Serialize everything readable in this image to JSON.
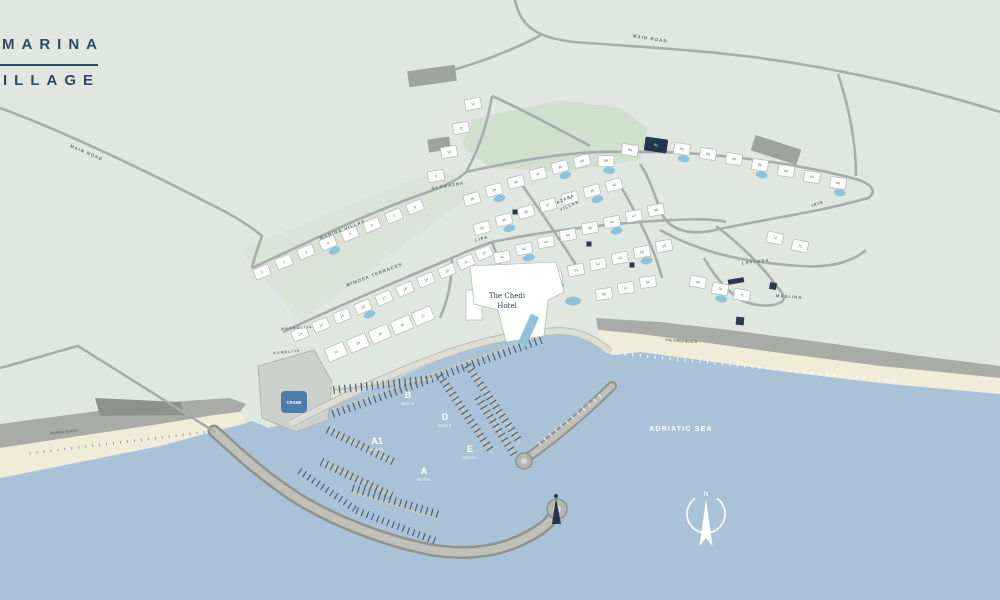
{
  "logo": {
    "line1": "MARINA",
    "line2": "VILLAGE"
  },
  "labels": {
    "main_road_top": "MAIN ROAD",
    "main_road_left": "MAIN ROAD",
    "marina_villas": "MARINA VILLAS",
    "mimosa_terraces": "MIMOSA TERRACES",
    "magnolija": "MAGNOLIJA",
    "kamelija": "KAMELIJA",
    "glomazna": "GLOMAZNA",
    "azara_villas_1": "AZARA",
    "azara_villas_2": "VILLAS",
    "lipa": "LIPA",
    "lavanda": "LAVANDA",
    "maslina": "MASLINA",
    "iris": "IRIS",
    "hotel_line1": "The Chedi",
    "hotel_line2": "Hotel",
    "chedi_beach": "THE CHEDI BEACH",
    "marina_beach": "MARINA BEACH",
    "adriatic_sea": "ADRIATIC SEA",
    "crane": "CRANE",
    "north": "N",
    "berth_word": "BERTH"
  },
  "berths": [
    {
      "name": "B",
      "x": 408,
      "y": 398
    },
    {
      "name": "D",
      "x": 445,
      "y": 420
    },
    {
      "name": "A1",
      "x": 377,
      "y": 444
    },
    {
      "name": "E",
      "x": 470,
      "y": 452
    },
    {
      "name": "A",
      "x": 424,
      "y": 474
    }
  ],
  "villas": [
    {
      "n": "1",
      "x": 262,
      "y": 272,
      "r": -23
    },
    {
      "n": "2",
      "x": 284,
      "y": 262,
      "r": -23
    },
    {
      "n": "3",
      "x": 306,
      "y": 252,
      "r": -23
    },
    {
      "n": "4",
      "x": 328,
      "y": 243,
      "r": -23,
      "p": true
    },
    {
      "n": "5",
      "x": 350,
      "y": 234,
      "r": -23
    },
    {
      "n": "6",
      "x": 372,
      "y": 225,
      "r": -23
    },
    {
      "n": "7",
      "x": 394,
      "y": 216,
      "r": -23
    },
    {
      "n": "8",
      "x": 415,
      "y": 207,
      "r": -23
    },
    {
      "n": "9",
      "x": 436,
      "y": 176,
      "r": -10
    },
    {
      "n": "10",
      "x": 449,
      "y": 152,
      "r": -10
    },
    {
      "n": "11",
      "x": 461,
      "y": 128,
      "r": -10
    },
    {
      "n": "12",
      "x": 473,
      "y": 104,
      "r": -10
    },
    {
      "n": "13",
      "x": 300,
      "y": 334,
      "r": -23
    },
    {
      "n": "14",
      "x": 321,
      "y": 325,
      "r": -23
    },
    {
      "n": "15",
      "x": 342,
      "y": 316,
      "r": -23
    },
    {
      "n": "16",
      "x": 363,
      "y": 307,
      "r": -23,
      "p": true
    },
    {
      "n": "17",
      "x": 384,
      "y": 298,
      "r": -23
    },
    {
      "n": "18",
      "x": 405,
      "y": 289,
      "r": -23
    },
    {
      "n": "19",
      "x": 426,
      "y": 280,
      "r": -23
    },
    {
      "n": "20",
      "x": 447,
      "y": 271,
      "r": -23
    },
    {
      "n": "21",
      "x": 466,
      "y": 262,
      "r": -23
    },
    {
      "n": "22",
      "x": 484,
      "y": 253,
      "r": -23
    },
    {
      "n": "23",
      "x": 336,
      "y": 352,
      "r": -23,
      "w": 20,
      "h": 14
    },
    {
      "n": "24",
      "x": 358,
      "y": 343,
      "r": -23,
      "w": 20,
      "h": 14
    },
    {
      "n": "25",
      "x": 380,
      "y": 334,
      "r": -23,
      "w": 20,
      "h": 14
    },
    {
      "n": "26",
      "x": 402,
      "y": 325,
      "r": -23,
      "w": 20,
      "h": 14
    },
    {
      "n": "27",
      "x": 423,
      "y": 316,
      "r": -23,
      "w": 20,
      "h": 14
    },
    {
      "n": "28",
      "x": 472,
      "y": 199,
      "r": -15
    },
    {
      "n": "29",
      "x": 494,
      "y": 190,
      "r": -15,
      "p": true
    },
    {
      "n": "30",
      "x": 516,
      "y": 182,
      "r": -15
    },
    {
      "n": "31",
      "x": 538,
      "y": 174,
      "r": -15
    },
    {
      "n": "32",
      "x": 560,
      "y": 167,
      "r": -15,
      "p": true
    },
    {
      "n": "33",
      "x": 582,
      "y": 161,
      "r": -15
    },
    {
      "n": "34",
      "x": 482,
      "y": 228,
      "r": -15
    },
    {
      "n": "35",
      "x": 504,
      "y": 220,
      "r": -15,
      "p": true
    },
    {
      "n": "36",
      "x": 526,
      "y": 212,
      "r": -15
    },
    {
      "n": "37",
      "x": 548,
      "y": 205,
      "r": -15
    },
    {
      "n": "38",
      "x": 570,
      "y": 198,
      "r": -15
    },
    {
      "n": "39",
      "x": 592,
      "y": 191,
      "r": -15,
      "p": true
    },
    {
      "n": "40",
      "x": 614,
      "y": 185,
      "r": -15
    },
    {
      "n": "41",
      "x": 502,
      "y": 257,
      "r": -10
    },
    {
      "n": "42",
      "x": 524,
      "y": 249,
      "r": -10,
      "p": true
    },
    {
      "n": "43",
      "x": 546,
      "y": 242,
      "r": -10
    },
    {
      "n": "44",
      "x": 568,
      "y": 235,
      "r": -10
    },
    {
      "n": "45",
      "x": 590,
      "y": 228,
      "r": -10
    },
    {
      "n": "46",
      "x": 612,
      "y": 222,
      "r": -10,
      "p": true
    },
    {
      "n": "47",
      "x": 634,
      "y": 216,
      "r": -10
    },
    {
      "n": "48",
      "x": 656,
      "y": 210,
      "r": -10
    },
    {
      "n": "49",
      "x": 532,
      "y": 284,
      "r": -10
    },
    {
      "n": "50",
      "x": 554,
      "y": 277,
      "r": -10,
      "p": true
    },
    {
      "n": "51",
      "x": 576,
      "y": 270,
      "r": -10
    },
    {
      "n": "52",
      "x": 598,
      "y": 264,
      "r": -10
    },
    {
      "n": "53",
      "x": 620,
      "y": 258,
      "r": -10
    },
    {
      "n": "54",
      "x": 642,
      "y": 252,
      "r": -10,
      "p": true
    },
    {
      "n": "55",
      "x": 664,
      "y": 246,
      "r": -10
    },
    {
      "n": "56",
      "x": 604,
      "y": 294,
      "r": -8
    },
    {
      "n": "57",
      "x": 626,
      "y": 288,
      "r": -8
    },
    {
      "n": "58",
      "x": 648,
      "y": 282,
      "r": -8
    },
    {
      "n": "59",
      "x": 606,
      "y": 161,
      "r": 0,
      "p": true
    },
    {
      "n": "60",
      "x": 630,
      "y": 150,
      "r": 8
    },
    {
      "n": "61",
      "x": 656,
      "y": 145,
      "r": 8,
      "d": true,
      "w": 22,
      "h": 13
    },
    {
      "n": "62",
      "x": 682,
      "y": 149,
      "r": 8,
      "p": true
    },
    {
      "n": "63",
      "x": 708,
      "y": 154,
      "r": 8
    },
    {
      "n": "64",
      "x": 734,
      "y": 159,
      "r": 8
    },
    {
      "n": "65",
      "x": 760,
      "y": 165,
      "r": 8,
      "p": true
    },
    {
      "n": "66",
      "x": 786,
      "y": 171,
      "r": 8
    },
    {
      "n": "67",
      "x": 812,
      "y": 177,
      "r": 8
    },
    {
      "n": "68",
      "x": 838,
      "y": 183,
      "r": 8,
      "p": true
    },
    {
      "n": "69",
      "x": 698,
      "y": 282,
      "r": 10
    },
    {
      "n": "70",
      "x": 720,
      "y": 289,
      "r": 10,
      "p": true
    },
    {
      "n": "71",
      "x": 742,
      "y": 295,
      "r": 10
    },
    {
      "n": "72",
      "x": 775,
      "y": 238,
      "r": 12
    },
    {
      "n": "73",
      "x": 800,
      "y": 246,
      "r": 12
    }
  ],
  "pontoons": [
    {
      "x1": 332,
      "y1": 410,
      "x2": 540,
      "y2": 336,
      "side": "left",
      "len": 8,
      "sp": 5.5,
      "c": "#4e6170",
      "lw": 1.2,
      "base": true
    },
    {
      "x1": 334,
      "y1": 390,
      "x2": 432,
      "y2": 379,
      "side": "both",
      "len": 8,
      "sp": 5.5,
      "c": "#4e6170",
      "lw": 1.2,
      "base": true
    },
    {
      "x1": 328,
      "y1": 430,
      "x2": 394,
      "y2": 462,
      "side": "both",
      "len": 8,
      "sp": 5.5,
      "c": "#4e6170",
      "lw": 1.2,
      "base": true
    },
    {
      "x1": 322,
      "y1": 462,
      "x2": 392,
      "y2": 496,
      "side": "both",
      "len": 8,
      "sp": 5.5,
      "c": "#4e6170",
      "lw": 1.2,
      "base": true
    },
    {
      "x1": 352,
      "y1": 492,
      "x2": 440,
      "y2": 519,
      "side": "right",
      "len": 8,
      "sp": 5.5,
      "c": "#4e6170",
      "lw": 1.2,
      "base": true
    },
    {
      "x1": 440,
      "y1": 376,
      "x2": 492,
      "y2": 452,
      "side": "both",
      "len": 8,
      "sp": 5.5,
      "c": "#4e6170",
      "lw": 1.2,
      "base": true
    },
    {
      "x1": 468,
      "y1": 366,
      "x2": 520,
      "y2": 442,
      "side": "both",
      "len": 8,
      "sp": 5.5,
      "c": "#4e6170",
      "lw": 1.2,
      "base": true
    },
    {
      "x1": 478,
      "y1": 398,
      "x2": 514,
      "y2": 454,
      "side": "both",
      "len": 8,
      "sp": 5.5,
      "c": "#4e6170",
      "lw": 1.2,
      "base": true
    },
    {
      "x1": 298,
      "y1": 474,
      "x2": 356,
      "y2": 514,
      "side": "right",
      "len": 7,
      "sp": 5.5,
      "c": "#4e6170",
      "lw": 1.2,
      "base": false
    },
    {
      "x1": 356,
      "y1": 514,
      "x2": 436,
      "y2": 545,
      "side": "right",
      "len": 7,
      "sp": 5.5,
      "c": "#4e6170",
      "lw": 1.2,
      "base": false
    },
    {
      "x1": 600,
      "y1": 396,
      "x2": 536,
      "y2": 446,
      "side": "both",
      "len": 4,
      "sp": 7,
      "c": "#ffffff",
      "lw": 1,
      "base": false
    },
    {
      "x1": 618,
      "y1": 352,
      "x2": 900,
      "y2": 380,
      "side": "left",
      "len": 3,
      "sp": 7.5,
      "c": "#ffffff",
      "lw": 1,
      "base": false
    },
    {
      "x1": 30,
      "y1": 452,
      "x2": 205,
      "y2": 431,
      "side": "left",
      "len": 2.5,
      "sp": 7,
      "c": "#7c8288",
      "lw": 0.8,
      "base": false
    }
  ],
  "markers": [
    {
      "x": 515,
      "y": 212,
      "w": 5,
      "h": 5,
      "r": 0
    },
    {
      "x": 589,
      "y": 244,
      "w": 5,
      "h": 5,
      "r": 0
    },
    {
      "x": 632,
      "y": 265,
      "w": 5,
      "h": 5,
      "r": 0
    },
    {
      "x": 736,
      "y": 281,
      "w": 16,
      "h": 5,
      "r": -10
    },
    {
      "x": 773,
      "y": 286,
      "w": 7,
      "h": 7,
      "r": 10
    },
    {
      "x": 740,
      "y": 321,
      "w": 8,
      "h": 8,
      "r": 5
    }
  ],
  "colors": {
    "land": "#e0e7e1",
    "sea": "#a9c2d8",
    "sand": "#f1ecd8",
    "rock": "#a9aba7",
    "road": "#a6aeac",
    "building": "#ffffff",
    "navy": "#22364e",
    "pool": "#8fc3dc",
    "boat": "#4e6170",
    "green": "#cfe0cd",
    "crane_badge": "#4e7ca8",
    "logo_navy": "#2b4a63"
  }
}
